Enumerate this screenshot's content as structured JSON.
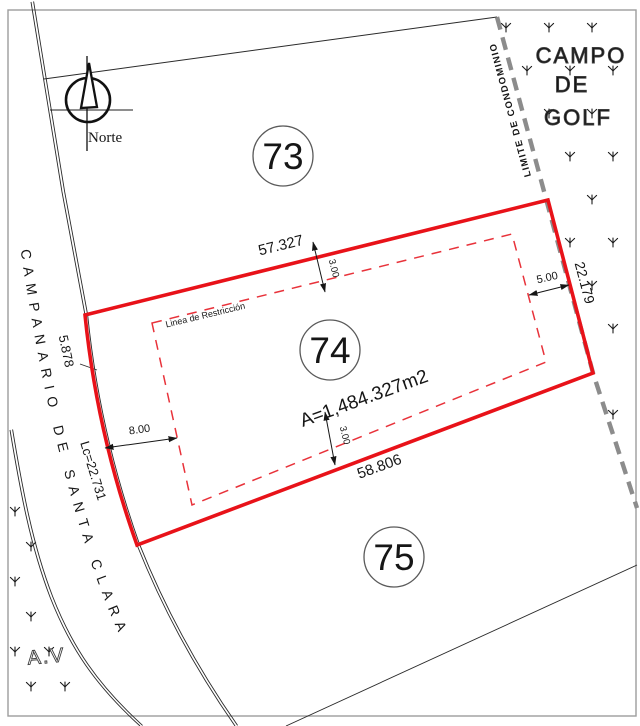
{
  "drawing": {
    "north_label": "Norte",
    "street_name": "CAMPANARIO DE SANTA CLARA",
    "golf_area": {
      "line1": "CAMPO",
      "line2": "DE",
      "line3": "GOLF"
    },
    "condo_limit_label": "LIMITE DE CONDOMINIO",
    "green_area_label": "A.V",
    "lots": [
      {
        "number": "73"
      },
      {
        "number": "74",
        "area_label": "A=1,484.327m2",
        "restriction_label": "Linea de Restricción"
      },
      {
        "number": "75"
      }
    ],
    "dimensions": {
      "top_side": "57.327",
      "bottom_side": "58.806",
      "right_side": "22.179",
      "left_upper": "5.878",
      "left_curve": "Lc=22.731",
      "setback_top": "3.00",
      "setback_bottom": "3.00",
      "setback_left": "8.00",
      "setback_right": "5.00"
    },
    "colors": {
      "parcel_red": "#e81219",
      "boundary_gray": "#8c8c8c",
      "line_black": "#1c1c1c"
    }
  }
}
